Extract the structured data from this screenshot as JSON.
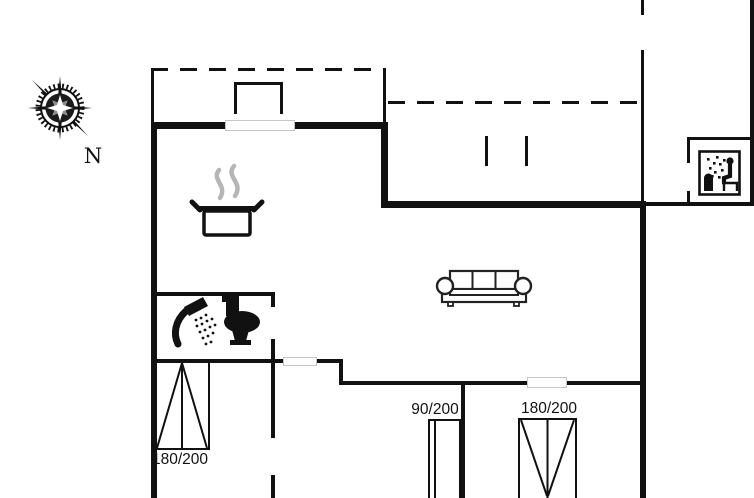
{
  "floorplan": {
    "compass": {
      "label": "N"
    },
    "bed_labels": {
      "left": "180/200",
      "middle": "90/200",
      "right": "180/200"
    },
    "icons": [
      "compass-rose-icon",
      "steaming-pot-icon",
      "shower-icon",
      "toilet-icon",
      "sofa-icon",
      "sauna-icon"
    ],
    "colors": {
      "wall": "#111111",
      "steam": "#b5b5b5",
      "window_outline": "#c6c6c6",
      "background": "#ffffff"
    }
  }
}
